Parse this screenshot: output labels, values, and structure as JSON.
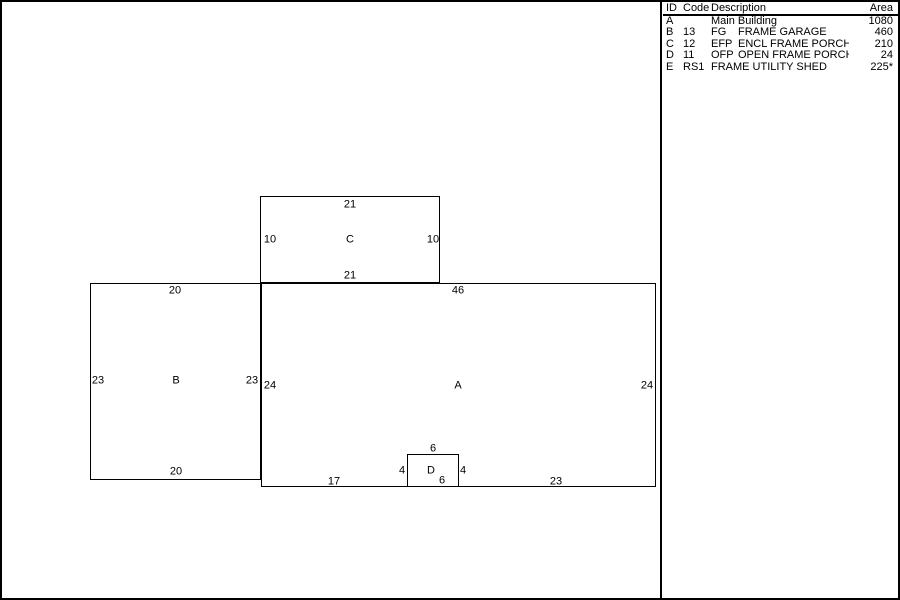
{
  "colors": {
    "background": "#ffffff",
    "line": "#000000",
    "text": "#000000"
  },
  "legend": {
    "headers": {
      "id": "ID",
      "code": "Code",
      "description": "Description",
      "area": "Area"
    },
    "rows": [
      {
        "id": "A",
        "code": "",
        "abbr": "",
        "name": "Main Building",
        "area": "1080"
      },
      {
        "id": "B",
        "code": "13",
        "abbr": "FG",
        "name": "FRAME GARAGE",
        "area": "460"
      },
      {
        "id": "C",
        "code": "12",
        "abbr": "EFP",
        "name": "ENCL FRAME PORCH",
        "area": "210"
      },
      {
        "id": "D",
        "code": "11",
        "abbr": "OFP",
        "name": "OPEN FRAME PORCH",
        "area": "24"
      },
      {
        "id": "E",
        "code": "RS1",
        "abbr": "",
        "name": "FRAME UTILITY SHED",
        "area": "225*"
      }
    ]
  },
  "sketch": {
    "labels": {
      "c_top": "21",
      "c_left": "10",
      "c_letter": "C",
      "c_right": "10",
      "c_bottom": "21",
      "b_top": "20",
      "a_top": "46",
      "b_left": "23",
      "b_letter": "B",
      "b_right": "23",
      "a_left": "24",
      "a_letter": "A",
      "a_right": "24",
      "d_top": "6",
      "d_left": "4",
      "d_letter": "D",
      "d_right": "4",
      "d_bottom": "6",
      "b_bottom": "20",
      "a_bottom_left": "17",
      "a_bottom_right": "23"
    }
  }
}
